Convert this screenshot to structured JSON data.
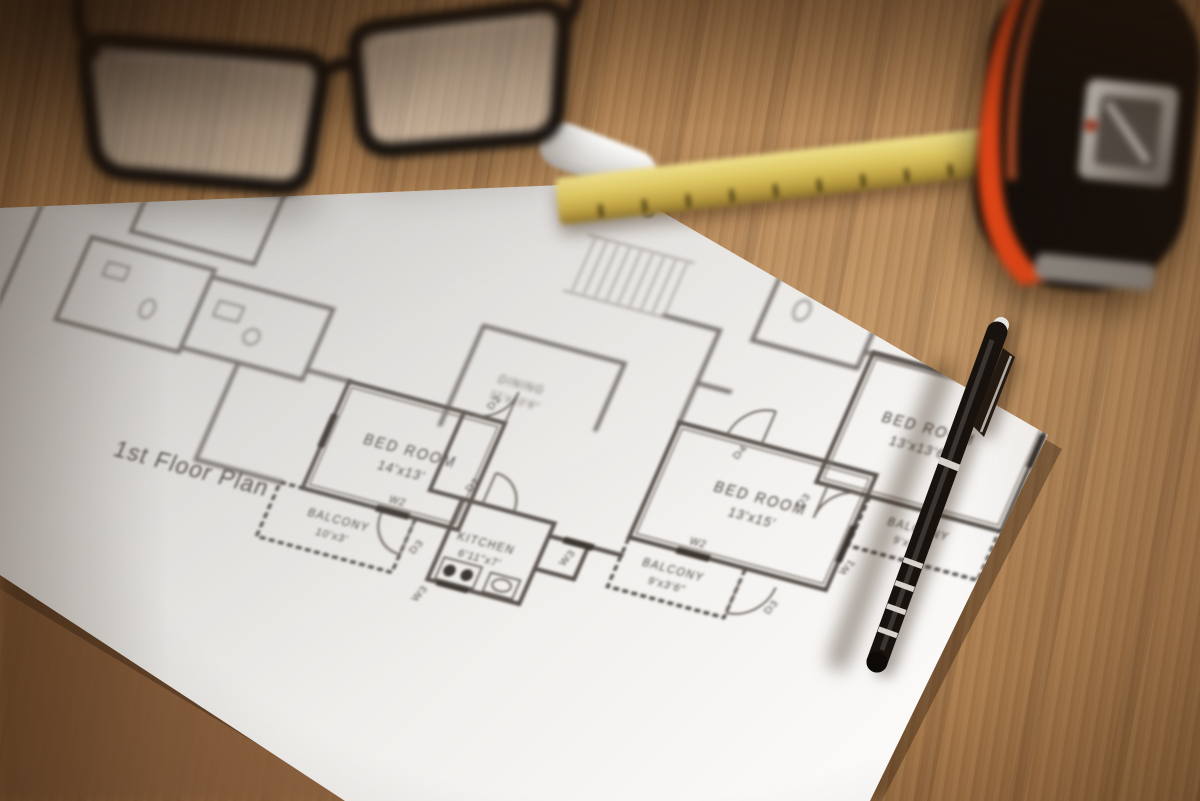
{
  "floor_plan": {
    "title": "1st Floor Plan",
    "rooms": {
      "bedroom1": {
        "name": "BED ROOM",
        "dims": "14'x13'"
      },
      "balcony1": {
        "name": "BALCONY",
        "dims": "10'x3'"
      },
      "kitchen": {
        "name": "KITCHEN",
        "dims": "6'11\"x7'"
      },
      "dining": {
        "name": "DINING",
        "dims": "11'x10'6\""
      },
      "bedroom2": {
        "name": "BED ROOM",
        "dims": "13'x15'"
      },
      "balcony2": {
        "name": "BALCONY",
        "dims": "9'x3'6\""
      },
      "bedroom3": {
        "name": "BED ROOM",
        "dims": "13'x13'6\""
      },
      "balcony3": {
        "name": "BALCONY",
        "dims": "9'x3'6\""
      }
    },
    "tags": {
      "window1": "W1",
      "window2": "W2",
      "window3": "W3",
      "door2": "D2",
      "door3": "D3",
      "door4": "D4"
    }
  },
  "colors": {
    "wood": "#a87c50",
    "wood_dark": "#5f4026",
    "paper": "#f4f2ef",
    "plan_line": "#5a524d",
    "ruler_yellow": "#d9c45f",
    "tape_orange": "#df4517",
    "tape_body": "#140e0a",
    "pen_black": "#18120e",
    "window_tag_red": "#7c2e24"
  }
}
